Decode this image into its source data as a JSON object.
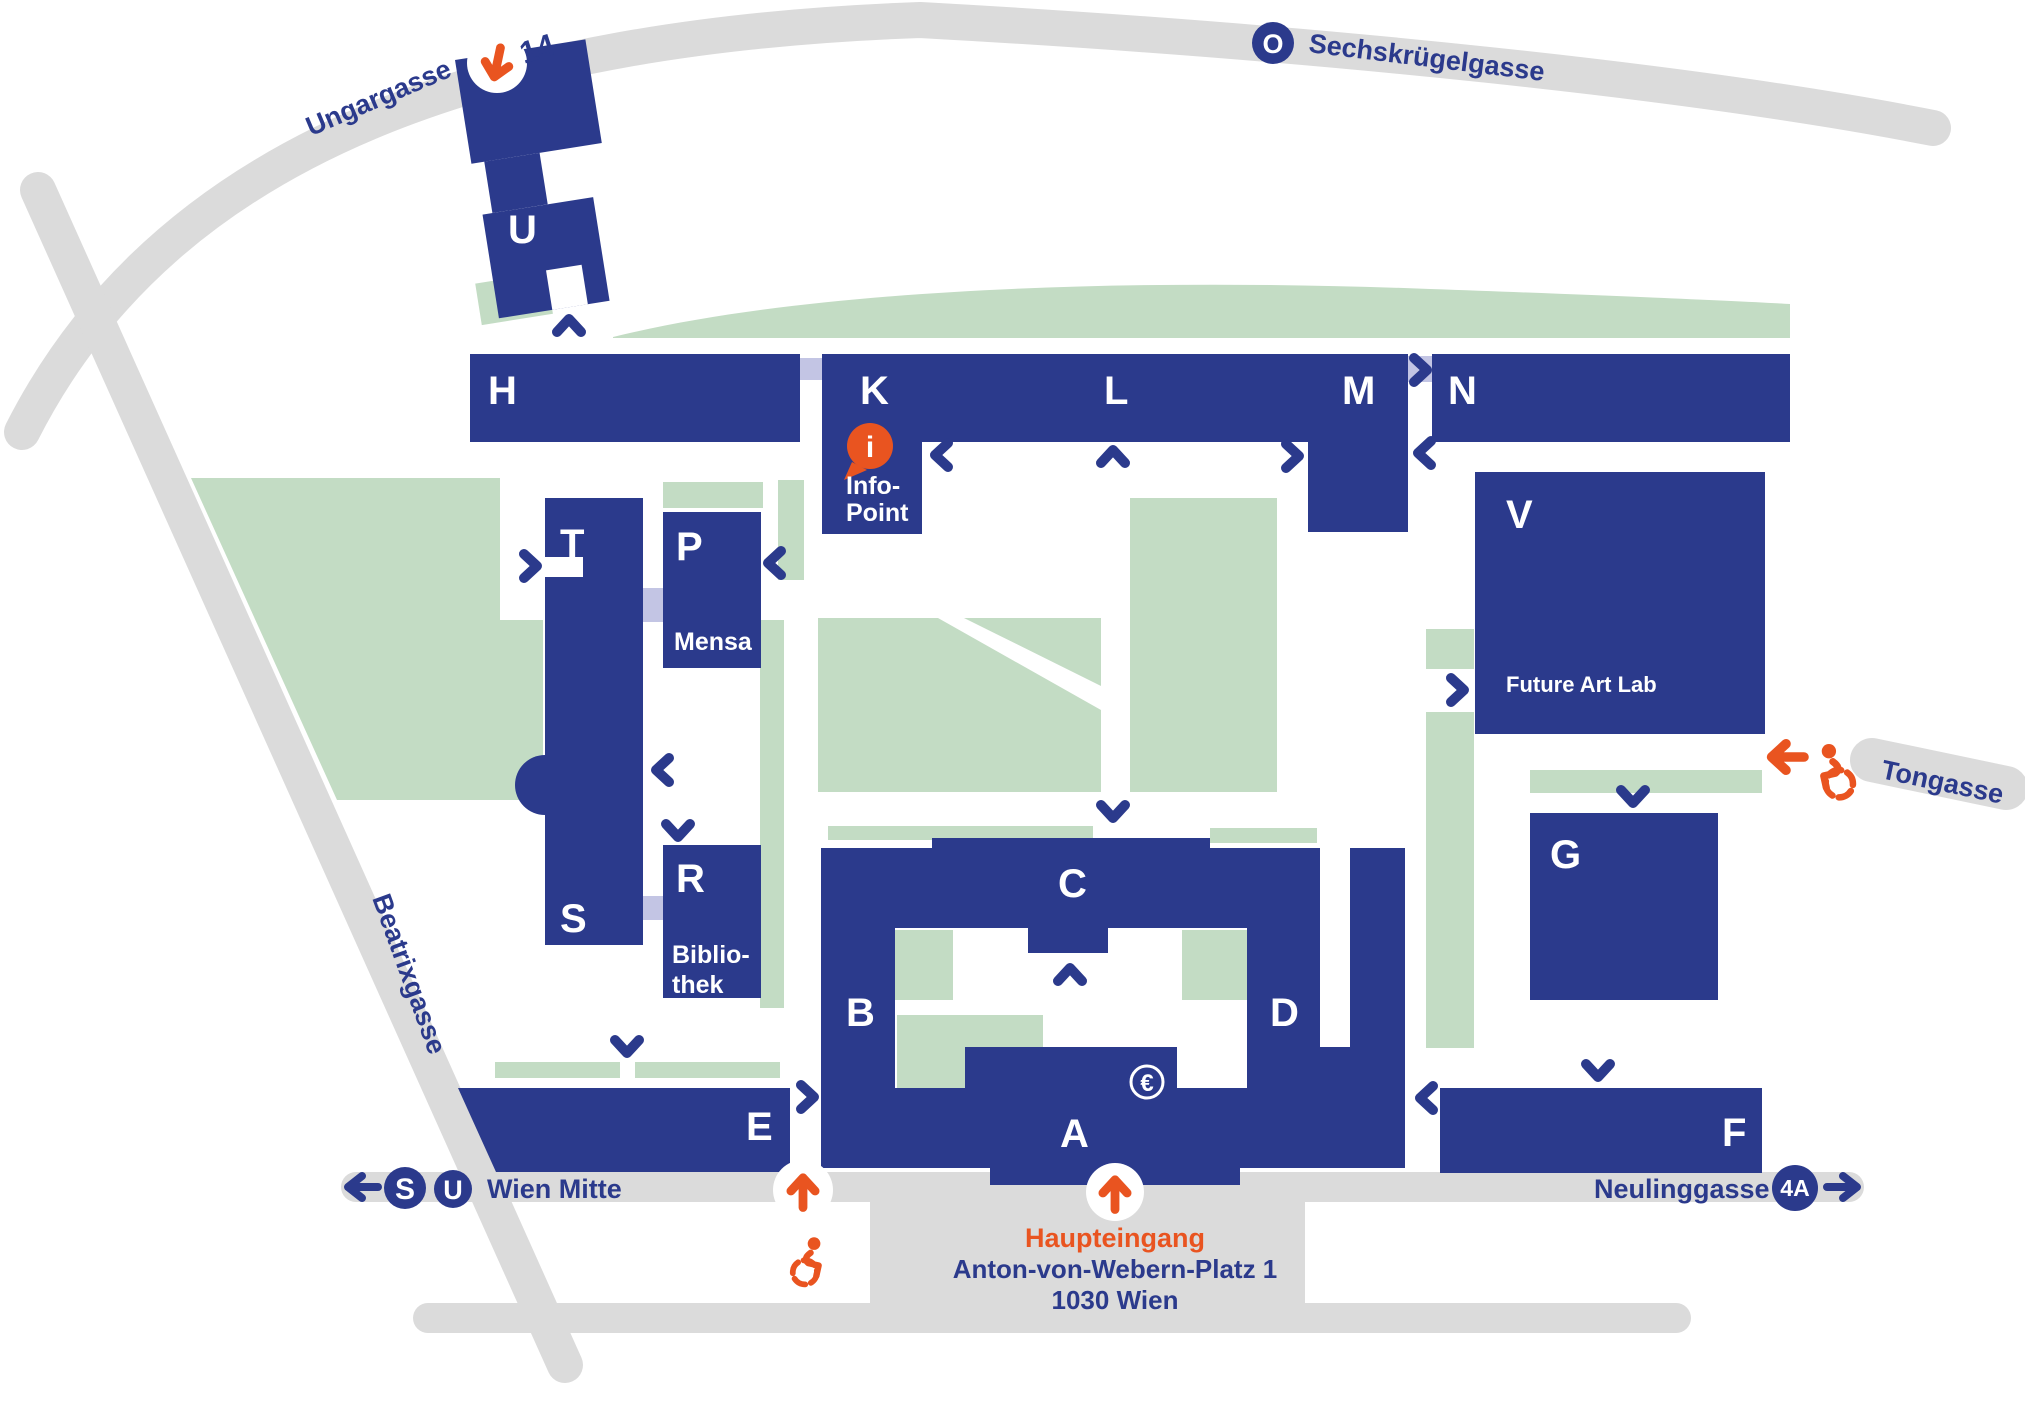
{
  "colors": {
    "building_blue": "#2b3a8c",
    "green_area": "#c3dcc4",
    "connector_lavender": "#c3c5e4",
    "street_gray": "#dbdbdb",
    "accent_orange": "#e95420",
    "white": "#ffffff"
  },
  "buildings": {
    "u": "U",
    "h": "H",
    "k": "K",
    "l": "L",
    "m": "M",
    "n": "N",
    "t": "T",
    "p": "P",
    "s": "S",
    "r": "R",
    "v": "V",
    "e": "E",
    "b": "B",
    "c": "C",
    "d": "D",
    "a": "A",
    "f": "F",
    "g": "G"
  },
  "building_sublabels": {
    "mensa": "Mensa",
    "bibliothek_line1": "Biblio-",
    "bibliothek_line2": "thek",
    "future_art_lab": "Future Art Lab"
  },
  "info_point": {
    "line1": "Info-",
    "line2": "Point",
    "icon_letter": "i"
  },
  "streets": {
    "ungargasse": "Ungargasse",
    "sechskruegelgasse": "Sechskrügelgasse",
    "beatrixgasse": "Beatrixgasse",
    "tongasse": "Tongasse",
    "neulinggasse": "Neulinggasse",
    "wien_mitte": "Wien Mitte"
  },
  "transit": {
    "tram_14": "14",
    "tram_o": "O",
    "s_bahn": "S",
    "u_bahn": "U",
    "bus_4a": "4A"
  },
  "main_entrance": {
    "title": "Haupteingang",
    "address_line1": "Anton-von-Webern-Platz 1",
    "address_line2": "1030 Wien"
  },
  "symbols": {
    "euro": "€"
  }
}
